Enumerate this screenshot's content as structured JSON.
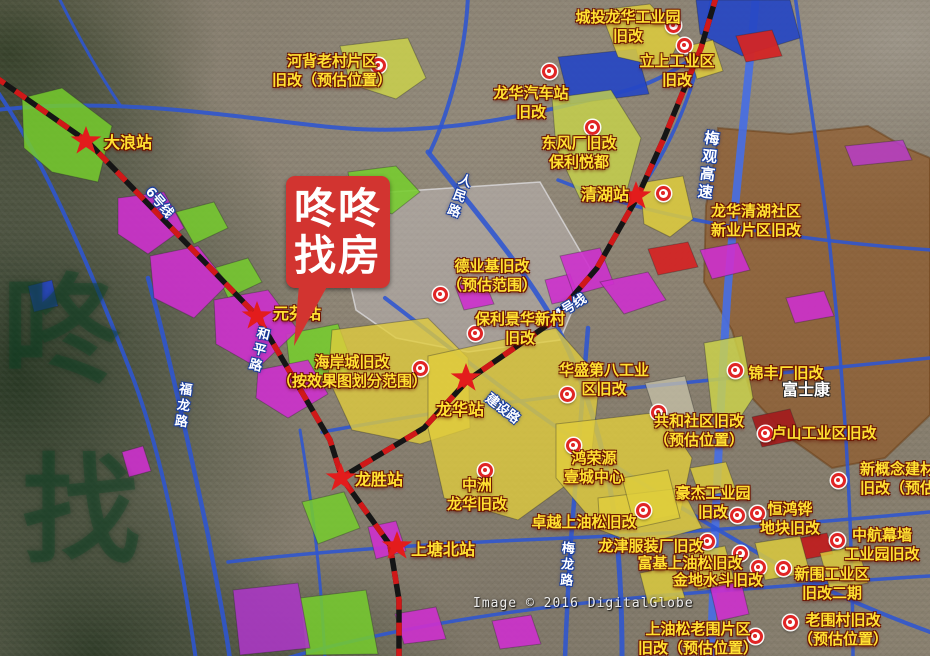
{
  "logo": {
    "line1": "咚咚",
    "line2": "找房"
  },
  "satellite_watermark": "Image © 2016 DigitalGlobe",
  "brand_watermark_chars": [
    {
      "ch": "咚",
      "x": 2,
      "y": 272
    },
    {
      "ch": "找",
      "x": 22,
      "y": 452
    }
  ],
  "colors": {
    "label_yellow": "#ffe232",
    "pin_red": "#e02525",
    "star_red": "#e31c1c",
    "logo_red": "#d23430",
    "road_blue": "#2d55d2",
    "metro_black": "#151515",
    "metro_red": "#d01818",
    "foxconn_brown": "#92521b"
  },
  "stations": [
    {
      "name": "大浪站",
      "star": [
        86,
        141
      ],
      "lx": 104,
      "ly": 129
    },
    {
      "name": "元芬站",
      "star": [
        257,
        316
      ],
      "lx": 273,
      "ly": 300
    },
    {
      "name": "清湖站",
      "star": [
        636,
        196
      ],
      "lx": 581,
      "ly": 181
    },
    {
      "name": "龙华站",
      "star": [
        466,
        378
      ],
      "lx": 436,
      "ly": 396
    },
    {
      "name": "龙胜站",
      "star": [
        341,
        478
      ],
      "lx": 355,
      "ly": 466
    },
    {
      "name": "上塘北站",
      "star": [
        397,
        546
      ],
      "lx": 411,
      "ly": 536
    }
  ],
  "metro_labels": [
    {
      "name": "6号线",
      "x": 143,
      "y": 192,
      "rot": 50,
      "vert": false
    },
    {
      "name": "4号线",
      "x": 552,
      "y": 296,
      "rot": -32,
      "vert": false
    }
  ],
  "road_labels": [
    {
      "name": "人民路",
      "x": 448,
      "y": 172,
      "rot": 20,
      "vert": true
    },
    {
      "name": "和平路",
      "x": 248,
      "y": 326,
      "rot": 14,
      "vert": true
    },
    {
      "name": "福龙路",
      "x": 172,
      "y": 382,
      "rot": 8,
      "vert": true
    },
    {
      "name": "梅龙路",
      "x": 556,
      "y": 541,
      "rot": 3,
      "vert": true
    },
    {
      "name": "梅观高速",
      "x": 698,
      "y": 130,
      "rot": 7,
      "vert": true
    },
    {
      "name": "建设路",
      "x": 484,
      "y": 398,
      "rot": 38,
      "vert": false
    }
  ],
  "sites": [
    {
      "lines": [
        "河背老村片区",
        "旧改（预估位置）"
      ],
      "x": 332,
      "y": 52
    },
    {
      "lines": [
        "城投龙华工业园",
        "旧改"
      ],
      "x": 628,
      "y": 8
    },
    {
      "lines": [
        "立上工业区",
        "旧改"
      ],
      "x": 677,
      "y": 52
    },
    {
      "lines": [
        "龙华汽车站",
        "旧改"
      ],
      "x": 531,
      "y": 84
    },
    {
      "lines": [
        "东风厂旧改",
        "保利悦都"
      ],
      "x": 579,
      "y": 134
    },
    {
      "lines": [
        "龙华清湖社区",
        "新业片区旧改"
      ],
      "x": 756,
      "y": 202
    },
    {
      "lines": [
        "德业基旧改",
        "（预估范围）"
      ],
      "x": 492,
      "y": 257
    },
    {
      "lines": [
        "保利景华新村",
        "旧改"
      ],
      "x": 520,
      "y": 310
    },
    {
      "lines": [
        "海岸城旧改",
        "（按效果图划分范围）"
      ],
      "x": 352,
      "y": 353
    },
    {
      "lines": [
        "华盛第八工业",
        "区旧改"
      ],
      "x": 604,
      "y": 361
    },
    {
      "lines": [
        "锦丰厂旧改"
      ],
      "x": 786,
      "y": 364
    },
    {
      "lines": [
        "共和社区旧改",
        "（预估位置）"
      ],
      "x": 699,
      "y": 412
    },
    {
      "lines": [
        "卢山工业区旧改"
      ],
      "x": 824,
      "y": 424
    },
    {
      "lines": [
        "新概念建材",
        "旧改（预估位置）"
      ],
      "x": 860,
      "y": 460,
      "align": "left"
    },
    {
      "lines": [
        "豪杰工业园",
        "旧改"
      ],
      "x": 713,
      "y": 484
    },
    {
      "lines": [
        "恒鸿铧",
        "地块旧改"
      ],
      "x": 790,
      "y": 500
    },
    {
      "lines": [
        "中航幕墙",
        "工业园旧改"
      ],
      "x": 882,
      "y": 526
    },
    {
      "lines": [
        "龙津服装厂旧改"
      ],
      "x": 651,
      "y": 537
    },
    {
      "lines": [
        "富基上油松旧改"
      ],
      "x": 690,
      "y": 554
    },
    {
      "lines": [
        "金地水斗旧改"
      ],
      "x": 718,
      "y": 571
    },
    {
      "lines": [
        "新围工业区",
        "旧改二期"
      ],
      "x": 832,
      "y": 565
    },
    {
      "lines": [
        "老围村旧改",
        "（预估位置）"
      ],
      "x": 843,
      "y": 611
    },
    {
      "lines": [
        "上油松老围片区",
        "旧改（预估位置）"
      ],
      "x": 698,
      "y": 620
    },
    {
      "lines": [
        "中洲",
        "龙华旧改"
      ],
      "x": 477,
      "y": 476
    },
    {
      "lines": [
        "鸿荣源",
        "壹城中心"
      ],
      "x": 594,
      "y": 449
    },
    {
      "lines": [
        "卓越上油松旧改"
      ],
      "x": 584,
      "y": 513
    },
    {
      "lines": [
        "富士康"
      ],
      "x": 806,
      "y": 380,
      "style": "white"
    }
  ],
  "pins": [
    [
      378,
      65
    ],
    [
      673,
      25
    ],
    [
      684,
      45
    ],
    [
      549,
      71
    ],
    [
      592,
      127
    ],
    [
      663,
      193
    ],
    [
      440,
      294
    ],
    [
      475,
      333
    ],
    [
      420,
      368
    ],
    [
      567,
      394
    ],
    [
      735,
      370
    ],
    [
      658,
      412
    ],
    [
      765,
      433
    ],
    [
      838,
      480
    ],
    [
      573,
      445
    ],
    [
      485,
      470
    ],
    [
      737,
      515
    ],
    [
      757,
      513
    ],
    [
      837,
      540
    ],
    [
      707,
      541
    ],
    [
      740,
      553
    ],
    [
      758,
      567
    ],
    [
      783,
      568
    ],
    [
      790,
      622
    ],
    [
      755,
      636
    ],
    [
      643,
      510
    ]
  ]
}
